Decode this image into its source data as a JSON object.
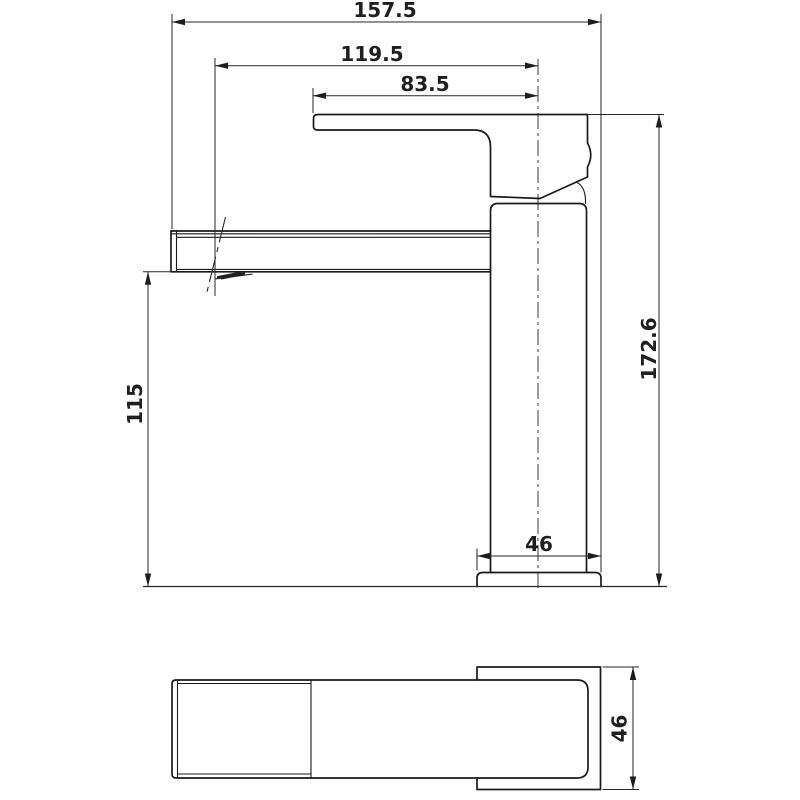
{
  "colors": {
    "line": "#1a1a1a",
    "dimension_line": "#262626",
    "background": "#ffffff"
  },
  "front_view": {
    "overall_length": "157.5",
    "aerator_reach": "119.5",
    "handle_reach": "83.5",
    "overall_height": "172.6",
    "spout_height": "115",
    "base_width": "46"
  },
  "top_view": {
    "base_depth": "46"
  }
}
